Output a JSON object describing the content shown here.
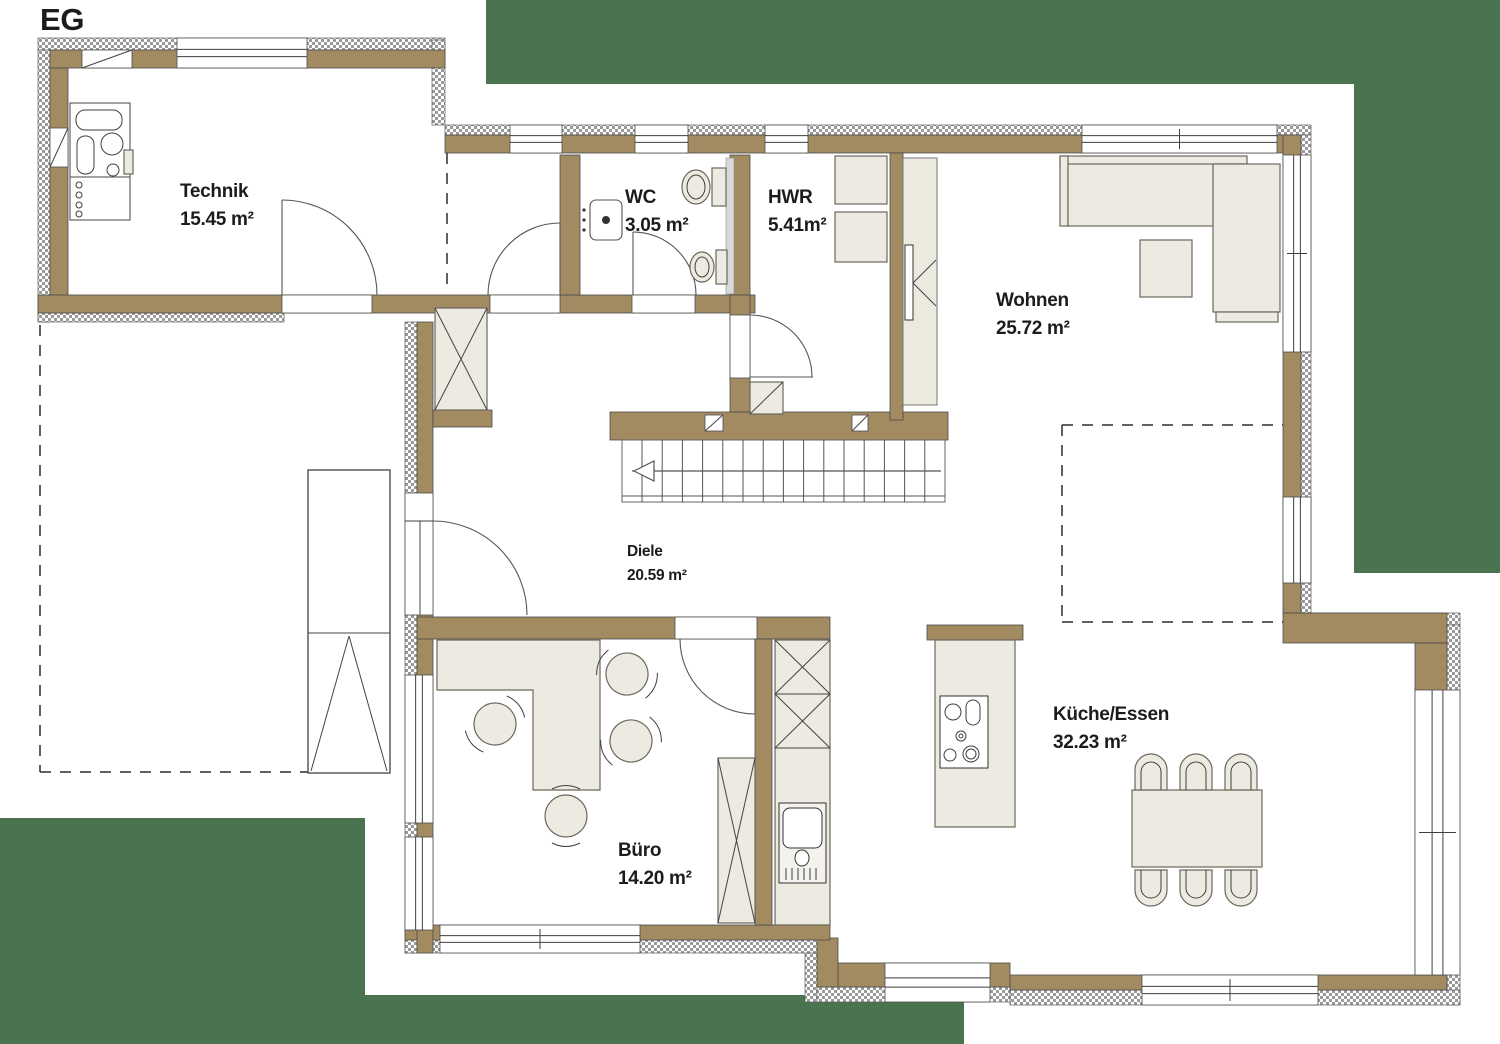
{
  "title": "EG",
  "colors": {
    "wall_brown": "#a28a61",
    "hatch_gray": "#9a9a9a",
    "furniture_beige": "#edeae2",
    "site_green": "#4a7350",
    "line_dark": "#3f3f3f",
    "text": "#1c1c1c"
  },
  "rooms": [
    {
      "id": "technik",
      "name": "Technik",
      "area": "15.45 m²",
      "x": 180,
      "y": 197,
      "small": false
    },
    {
      "id": "wc",
      "name": "WC",
      "area": "3.05 m²",
      "x": 625,
      "y": 203,
      "small": false
    },
    {
      "id": "hwr",
      "name": "HWR",
      "area": "5.41m²",
      "x": 768,
      "y": 203,
      "small": false
    },
    {
      "id": "wohnen",
      "name": "Wohnen",
      "area": "25.72 m²",
      "x": 996,
      "y": 306,
      "small": false
    },
    {
      "id": "diele",
      "name": "Diele",
      "area": "20.59 m²",
      "x": 627,
      "y": 556,
      "small": true
    },
    {
      "id": "buero",
      "name": "Büro",
      "area": "14.20 m²",
      "x": 618,
      "y": 856,
      "small": false
    },
    {
      "id": "kueche-essen",
      "name": "Küche/Essen",
      "area": "32.23 m²",
      "x": 1053,
      "y": 720,
      "small": false
    }
  ]
}
